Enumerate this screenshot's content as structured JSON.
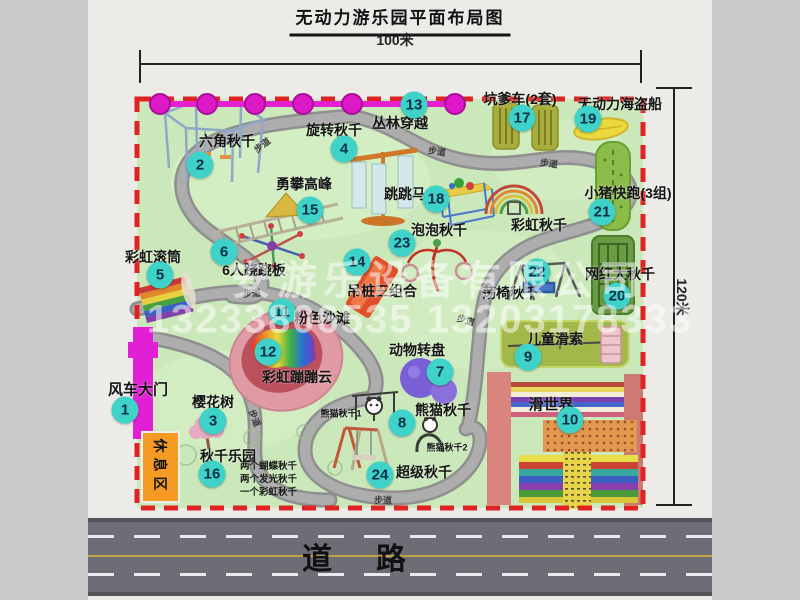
{
  "title": "无动力游乐园平面布局图",
  "dimension": {
    "horizontal": "100米",
    "vertical": "120米"
  },
  "road_label": "道路",
  "watermark": {
    "company": "安游乐设备有限公司",
    "phones": "13233806535 13203178333"
  },
  "map": {
    "trail_label": "步道",
    "rest_area_label": "休息区",
    "rainbow_swing_label": "彩虹秋千",
    "panda_swing_1_label": "熊猫秋千1",
    "panda_swing_2_label": "熊猫秋千2"
  },
  "attractions": [
    {
      "num": "1",
      "label": "风车大门"
    },
    {
      "num": "2",
      "label": "六角秋千"
    },
    {
      "num": "3",
      "label": "樱花树"
    },
    {
      "num": "4",
      "label": "旋转秋千"
    },
    {
      "num": "5",
      "label": "彩虹滚筒"
    },
    {
      "num": "6",
      "label": "6人跷跷板"
    },
    {
      "num": "7",
      "label": "动物转盘"
    },
    {
      "num": "8",
      "label": "熊猫秋千"
    },
    {
      "num": "9",
      "label": "儿童滑索"
    },
    {
      "num": "10",
      "label": "滑世界"
    },
    {
      "num": "11",
      "label": "粉色沙滩"
    },
    {
      "num": "12",
      "label": "彩虹蹦蹦云"
    },
    {
      "num": "13",
      "label": "丛林穿越"
    },
    {
      "num": "14",
      "label": "吊桩三组合"
    },
    {
      "num": "15",
      "label": "勇攀高峰"
    },
    {
      "num": "16",
      "label": "秋千乐园",
      "sublabels": [
        "两个蝴蝶秋千",
        "两个发光秋千",
        "一个彩虹秋千"
      ]
    },
    {
      "num": "17",
      "label": "坑爹车(2套)"
    },
    {
      "num": "18",
      "label": "跳跳马"
    },
    {
      "num": "19",
      "label": "无动力海盗船"
    },
    {
      "num": "20",
      "label": "网红大秋千"
    },
    {
      "num": "21",
      "label": "小猪快跑(3组)"
    },
    {
      "num": "22",
      "label": "荡椅秋千"
    },
    {
      "num": "23",
      "label": "泡泡秋千"
    },
    {
      "num": "24",
      "label": "超级秋千"
    }
  ],
  "colors": {
    "map_green": "#cbe8ba",
    "border_red": "#e02222",
    "badge_teal": "#3ed2c8",
    "zipline_magenta": "#e620d0",
    "gate_magenta": "#e11fd4",
    "rest_area_orange": "#f59a23"
  }
}
